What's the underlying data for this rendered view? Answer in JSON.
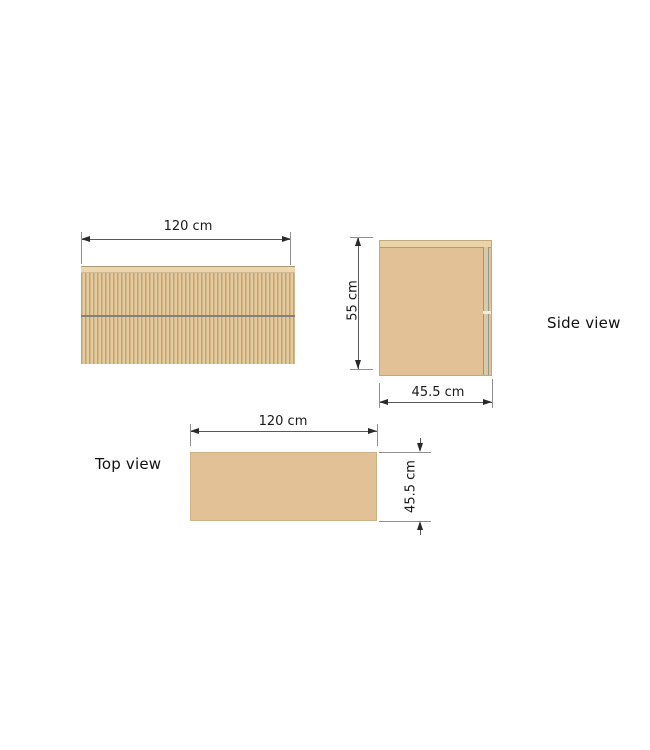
{
  "drawing": {
    "front_view": {
      "width_label": "120 cm"
    },
    "side_view": {
      "name_label": "Side view",
      "height_label": "55 cm",
      "depth_label": "45.5 cm"
    },
    "top_view": {
      "name_label": "Top view",
      "width_label": "120 cm",
      "depth_label": "45.5 cm"
    },
    "colors": {
      "background": "#ffffff",
      "wood_fill": "#e2c197",
      "flute_light": "#e9ca96",
      "flute_dark": "#b2a58a",
      "top_edge_strip": "#eed7ae",
      "dimension_line": "#5a5a5a",
      "extension_line": "#8f8f8f",
      "arrowhead": "#2a2a2a",
      "label_text": "#1a1a1a"
    }
  }
}
